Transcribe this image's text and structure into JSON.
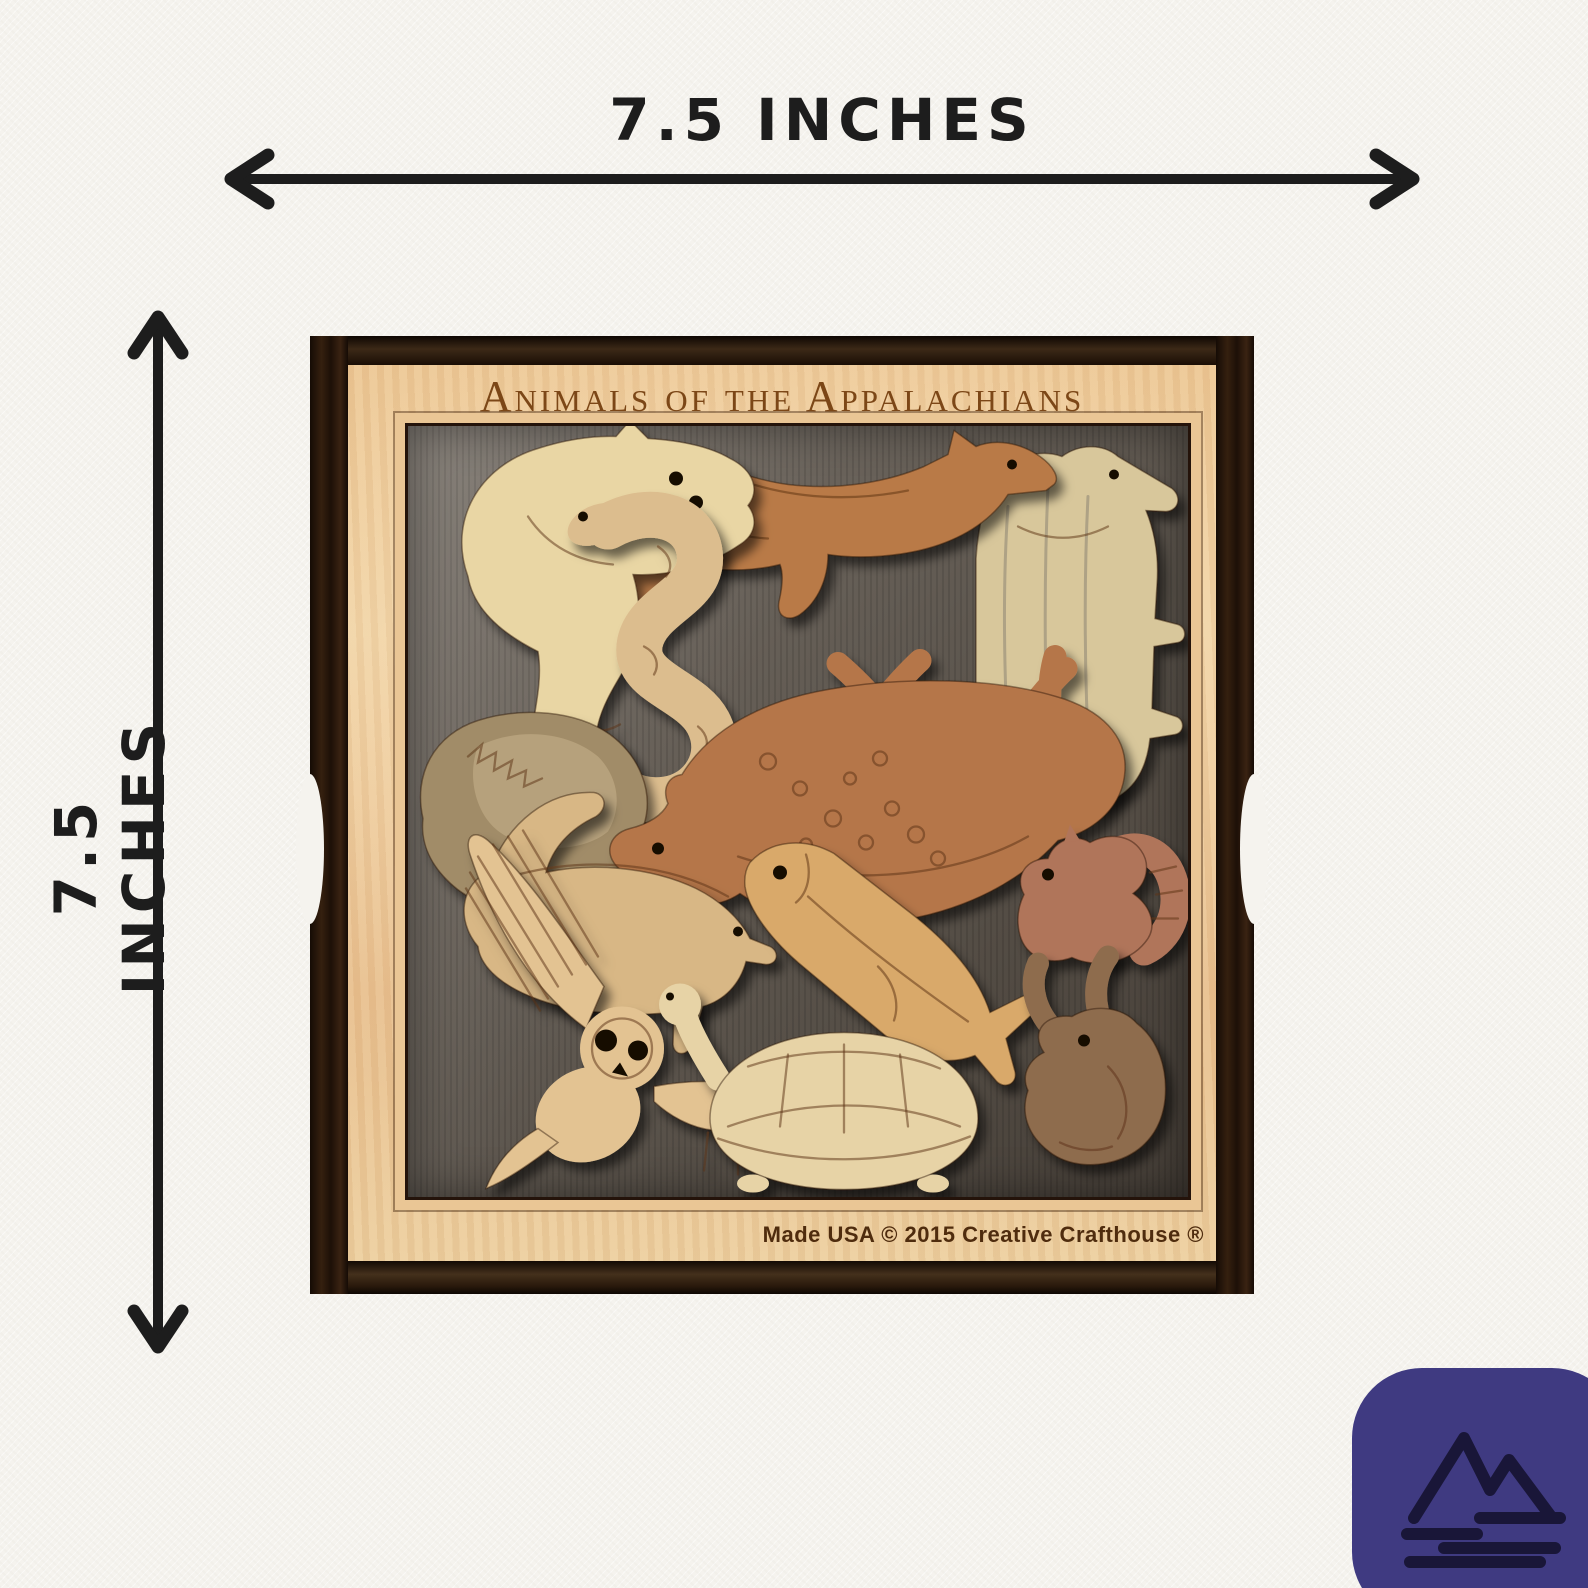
{
  "scene": {
    "paper_color": "#f5f3ee",
    "annotation_color": "#1d1d1d"
  },
  "dimension_annotations": {
    "width_label": "7.5 INCHES",
    "height_label": "7.5 INCHES"
  },
  "puzzle": {
    "title": "Animals of the Appalachians",
    "footer_text": "Made USA  © 2015 Creative Crafthouse ®",
    "colors": {
      "frame_face_maple": "#eccb9b",
      "frame_rail_walnut": "#241409",
      "tray_background": "#5e574f",
      "title_engraving": "#7c4717",
      "footer_engraving": "#4f2c0e"
    },
    "animals": [
      {
        "name": "raccoon",
        "wood": "#e9d6a4"
      },
      {
        "name": "red-fox",
        "wood": "#b97a47"
      },
      {
        "name": "black-bear",
        "wood": "#d8c79b"
      },
      {
        "name": "snake",
        "wood": "#dcbd8e"
      },
      {
        "name": "groundhog",
        "wood": "#a18c68"
      },
      {
        "name": "deer",
        "wood": "#b5764a"
      },
      {
        "name": "trout",
        "wood": "#d9a96b"
      },
      {
        "name": "skunk",
        "wood": "#d8b785"
      },
      {
        "name": "barn-owl",
        "wood": "#e3c392"
      },
      {
        "name": "turtle",
        "wood": "#e7d3a6"
      },
      {
        "name": "squirrel",
        "wood": "#b0745a"
      },
      {
        "name": "rabbit",
        "wood": "#8e6c4e"
      }
    ]
  },
  "logo": {
    "name": "mountain-lake-logo",
    "background_color": "#3f3a81",
    "icon_color": "#191638"
  }
}
